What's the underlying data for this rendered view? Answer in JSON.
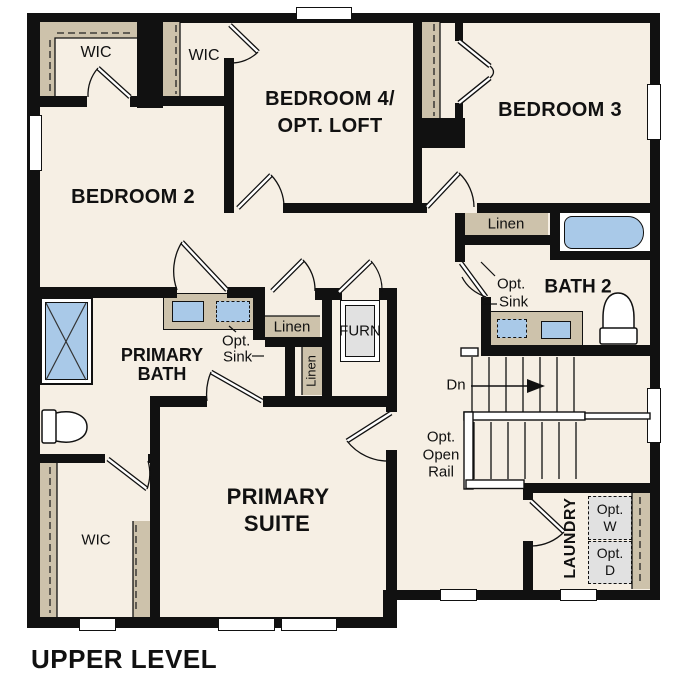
{
  "title": "UPPER LEVEL",
  "rooms": {
    "bedroom2": "BEDROOM 2",
    "bedroom4_line1": "BEDROOM 4/",
    "bedroom4_line2": "OPT. LOFT",
    "bedroom3": "BEDROOM 3",
    "bath2": "BATH 2",
    "primary_bath_line1": "PRIMARY",
    "primary_bath_line2": "BATH",
    "primary_suite_line1": "PRIMARY",
    "primary_suite_line2": "SUITE",
    "laundry": "LAUNDRY"
  },
  "closets": {
    "wic_bedroom2": "WIC",
    "wic_bedroom4": "WIC",
    "wic_primary": "WIC",
    "linen_bath2": "Linen",
    "linen_hall": "Linen",
    "linen_hall2": "Linen",
    "furnace": "FURN"
  },
  "annotations": {
    "bath2_opt_sink_line1": "Opt.",
    "bath2_opt_sink_line2": "Sink",
    "primary_opt_sink_line1": "Opt.",
    "primary_opt_sink_line2": "Sink",
    "stairs_direction": "Dn",
    "opt_open_rail_line1": "Opt.",
    "opt_open_rail_line2": "Open",
    "opt_open_rail_line3": "Rail",
    "opt_washer_line1": "Opt.",
    "opt_washer_line2": "W",
    "opt_dryer_line1": "Opt.",
    "opt_dryer_line2": "D"
  },
  "colors": {
    "wall": "#111111",
    "floor": "#f6efe4",
    "casework_tan": "#cdc2ab",
    "fixture_blue": "#a9c9e8",
    "appliance_gray": "#e1e1e1",
    "background": "#ffffff"
  }
}
